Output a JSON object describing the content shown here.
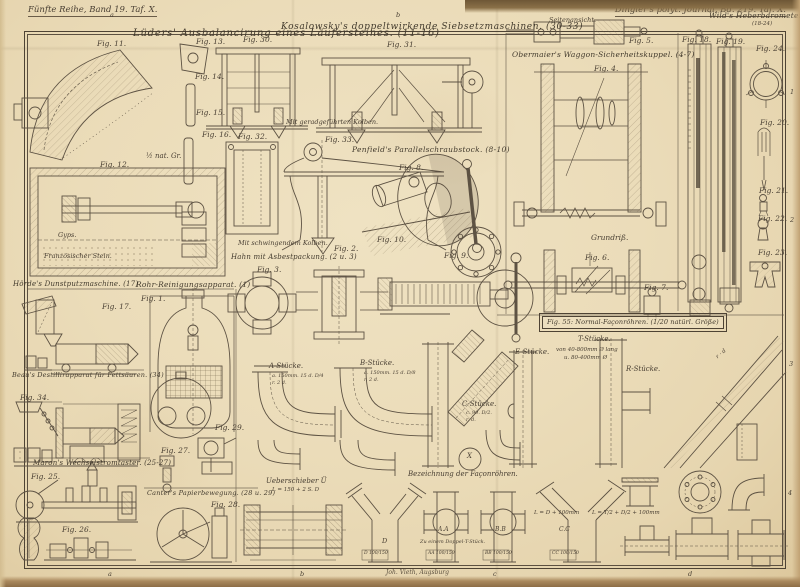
{
  "page": {
    "series_label": "Fünfte Reihe, Band 19. Taf. X.",
    "journal_label": "Dingler's polyt. Journal, Bd. 219. Taf. X.",
    "printer_credit": "Joh. Vieth, Augsburg",
    "colors": {
      "paper": "#ebdcb9",
      "ink": "#4a4034",
      "edge_dark": "#6e5736",
      "line": "#5d5243"
    }
  },
  "section_titles": [
    {
      "id": "lueders",
      "t": "Lüders' Ausbalancirung eines Läufersteines. (11-16)",
      "x": 133,
      "y": 29,
      "s": 10,
      "ls": 0.8
    },
    {
      "id": "kosalowsky",
      "t": "Kosalowsky's doppeltwirkende Siebsetzmaschinen. (30-33)",
      "x": 281,
      "y": 23,
      "s": 9,
      "ls": 0.6
    },
    {
      "id": "penfield",
      "t": "Penfield's Parallelschraubstock. (8-10)",
      "x": 352,
      "y": 146,
      "s": 7.5,
      "ls": 0.3
    },
    {
      "id": "hahn",
      "t": "Hahn mit Asbestpackung. (2 u. 3)",
      "x": 231,
      "y": 254,
      "s": 7,
      "ls": 0.2
    },
    {
      "id": "obermaier",
      "t": "Obermaier's Waggon-Sicherheitskuppel. (4-7)",
      "x": 512,
      "y": 51,
      "s": 7.5,
      "ls": 0.2
    },
    {
      "id": "wild",
      "t": "Wild's Heberbarometer.",
      "x": 709,
      "y": 12,
      "s": 7.5,
      "ls": 0.2
    },
    {
      "id": "hoerde",
      "t": "Hörde's Dunstputzmaschine. (17)",
      "x": 13,
      "y": 281,
      "s": 7,
      "ls": 0.2
    },
    {
      "id": "rohr",
      "t": "Rohr-Reinigungsapparat. (1)",
      "x": 136,
      "y": 281,
      "s": 7.5,
      "ls": 0.2
    },
    {
      "id": "beau",
      "t": "Beau's Destillirapparat für Fettsäuren. (34)",
      "x": 12,
      "y": 372,
      "s": 6.5,
      "ls": 0.2
    },
    {
      "id": "maron",
      "t": "Maron's Wechselstromtaster. (25-27)",
      "x": 33,
      "y": 460,
      "s": 7,
      "ls": 0.2
    },
    {
      "id": "canter",
      "t": "Canter's Papierbewegung. (28 u. 29)",
      "x": 147,
      "y": 490,
      "s": 6.5,
      "ls": 0.2
    },
    {
      "id": "fig55",
      "t": "Fig. 55: Normal-Façonröhren. (1/20 natürl. Größe)",
      "x": 542,
      "y": 316,
      "s": 6.5,
      "ls": 0.1,
      "boxed": true
    }
  ],
  "figure_labels": [
    {
      "t": "Fig. 11.",
      "x": 97,
      "y": 40
    },
    {
      "t": "Fig. 12.",
      "x": 100,
      "y": 161
    },
    {
      "t": "Fig. 13.",
      "x": 196,
      "y": 38
    },
    {
      "t": "Fig. 14.",
      "x": 195,
      "y": 73
    },
    {
      "t": "Fig. 15.",
      "x": 196,
      "y": 109
    },
    {
      "t": "Fig. 16.",
      "x": 202,
      "y": 131
    },
    {
      "t": "Fig. 30.",
      "x": 243,
      "y": 36
    },
    {
      "t": "Fig. 31.",
      "x": 387,
      "y": 41
    },
    {
      "t": "Fig. 32.",
      "x": 238,
      "y": 133
    },
    {
      "t": "Fig. 33.",
      "x": 325,
      "y": 136
    },
    {
      "t": "Fig. 8.",
      "x": 399,
      "y": 164
    },
    {
      "t": "Fig. 9.",
      "x": 444,
      "y": 252
    },
    {
      "t": "Fig. 10.",
      "x": 377,
      "y": 236
    },
    {
      "t": "Fig. 2.",
      "x": 334,
      "y": 245
    },
    {
      "t": "Fig. 3.",
      "x": 257,
      "y": 266
    },
    {
      "t": "Fig. 4.",
      "x": 594,
      "y": 65
    },
    {
      "t": "Fig. 5.",
      "x": 629,
      "y": 37
    },
    {
      "t": "Fig. 6.",
      "x": 585,
      "y": 254
    },
    {
      "t": "Fig. 7.",
      "x": 644,
      "y": 284
    },
    {
      "t": "Fig. 17.",
      "x": 102,
      "y": 303
    },
    {
      "t": "Fig. 1.",
      "x": 141,
      "y": 295
    },
    {
      "t": "Fig. 34.",
      "x": 20,
      "y": 394
    },
    {
      "t": "Fig. 25.",
      "x": 31,
      "y": 473
    },
    {
      "t": "Fig. 26.",
      "x": 62,
      "y": 526
    },
    {
      "t": "Fig. 27.",
      "x": 161,
      "y": 447
    },
    {
      "t": "Fig. 28.",
      "x": 211,
      "y": 501
    },
    {
      "t": "Fig. 29.",
      "x": 215,
      "y": 424
    },
    {
      "t": "Fig. 18.",
      "x": 682,
      "y": 36
    },
    {
      "t": "Fig. 19.",
      "x": 716,
      "y": 38
    },
    {
      "t": "Fig. 24.",
      "x": 756,
      "y": 45
    },
    {
      "t": "Fig. 20.",
      "x": 760,
      "y": 119
    },
    {
      "t": "Fig. 21.",
      "x": 759,
      "y": 187
    },
    {
      "t": "Fig. 22.",
      "x": 758,
      "y": 215
    },
    {
      "t": "Fig. 23.",
      "x": 758,
      "y": 249
    }
  ],
  "annotations": [
    {
      "t": "(18-24)",
      "x": 752,
      "y": 22,
      "s": 5.5
    },
    {
      "t": "Seitenansicht.",
      "x": 549,
      "y": 17,
      "s": 6.5
    },
    {
      "t": "Grundriß.",
      "x": 591,
      "y": 234,
      "s": 7.5
    },
    {
      "t": "Mit geradgeführten Kolben.",
      "x": 286,
      "y": 119,
      "s": 6.5
    },
    {
      "t": "Mit schwingendem Kolben.",
      "x": 238,
      "y": 240,
      "s": 6.5
    },
    {
      "t": "½ nat. Gr.",
      "x": 146,
      "y": 153,
      "s": 7
    },
    {
      "t": "Gyps.",
      "x": 58,
      "y": 232,
      "s": 6.5
    },
    {
      "t": "Französischer Stein.",
      "x": 44,
      "y": 253,
      "s": 6.5
    },
    {
      "t": "T-Stücke.",
      "x": 578,
      "y": 336,
      "s": 7
    },
    {
      "t": "von 40-800mm Ø lang",
      "x": 556,
      "y": 348,
      "s": 5.5
    },
    {
      "t": "u. 80-400mm Ø",
      "x": 564,
      "y": 356,
      "s": 5.5
    },
    {
      "t": "R-Stücke.",
      "x": 626,
      "y": 366,
      "s": 7
    },
    {
      "t": "A-Stücke.",
      "x": 269,
      "y": 363,
      "s": 7
    },
    {
      "t": "a. 150mm. 15 d. D/4",
      "x": 272,
      "y": 374,
      "s": 5
    },
    {
      "t": "r. 2 d.",
      "x": 272,
      "y": 381,
      "s": 5
    },
    {
      "t": "B-Stücke.",
      "x": 360,
      "y": 360,
      "s": 7
    },
    {
      "t": "a. 150mm. 15 d. D/8",
      "x": 364,
      "y": 371,
      "s": 5
    },
    {
      "t": "r. 2 d.",
      "x": 364,
      "y": 378,
      "s": 5
    },
    {
      "t": "C-Stücke.",
      "x": 462,
      "y": 401,
      "s": 7
    },
    {
      "t": "c. 90. D/2.",
      "x": 466,
      "y": 411,
      "s": 5
    },
    {
      "t": "r. d.",
      "x": 466,
      "y": 418,
      "s": 5
    },
    {
      "t": "E-Stücke.",
      "x": 515,
      "y": 349,
      "s": 7
    },
    {
      "t": "Ueberschieber Ü",
      "x": 266,
      "y": 478,
      "s": 7
    },
    {
      "t": "L = 150 + 2 S. D",
      "x": 272,
      "y": 488,
      "s": 5.5
    },
    {
      "t": "Bezeichnung der Façonröhren.",
      "x": 408,
      "y": 471,
      "s": 7
    },
    {
      "t": "Zu einem Doppel-T-Stück.",
      "x": 420,
      "y": 540,
      "s": 5
    },
    {
      "t": "L = D + 100mm",
      "x": 534,
      "y": 511,
      "s": 5.5
    },
    {
      "t": "L = T/2 + D/2 + 100mm",
      "x": 592,
      "y": 511,
      "s": 5.5
    },
    {
      "t": "D",
      "x": 382,
      "y": 538,
      "s": 6.5
    },
    {
      "t": "A.A",
      "x": 438,
      "y": 527,
      "s": 6
    },
    {
      "t": "B.B",
      "x": 495,
      "y": 527,
      "s": 6
    },
    {
      "t": "C.C",
      "x": 559,
      "y": 527,
      "s": 6
    },
    {
      "t": "X",
      "x": 467,
      "y": 453,
      "s": 7
    },
    {
      "t": "D 100/150",
      "x": 364,
      "y": 552,
      "s": 4.5
    },
    {
      "t": "AA 100/150",
      "x": 428,
      "y": 552,
      "s": 4.5
    },
    {
      "t": "BB 100/150",
      "x": 485,
      "y": 552,
      "s": 4.5
    },
    {
      "t": "CC 100/150",
      "x": 552,
      "y": 552,
      "s": 4.5
    },
    {
      "t": "r · d",
      "x": 716,
      "y": 352,
      "s": 5.5,
      "r": -40
    }
  ],
  "edge_markers": [
    {
      "t": "a",
      "x": 110,
      "y": 12
    },
    {
      "t": "b",
      "x": 396,
      "y": 12
    },
    {
      "t": "a",
      "x": 108,
      "y": 571
    },
    {
      "t": "b",
      "x": 300,
      "y": 571
    },
    {
      "t": "c",
      "x": 493,
      "y": 571
    },
    {
      "t": "d",
      "x": 688,
      "y": 571
    },
    {
      "t": "1",
      "x": 790,
      "y": 89
    },
    {
      "t": "2",
      "x": 790,
      "y": 217
    },
    {
      "t": "3",
      "x": 789,
      "y": 361
    },
    {
      "t": "4",
      "x": 788,
      "y": 490
    }
  ]
}
